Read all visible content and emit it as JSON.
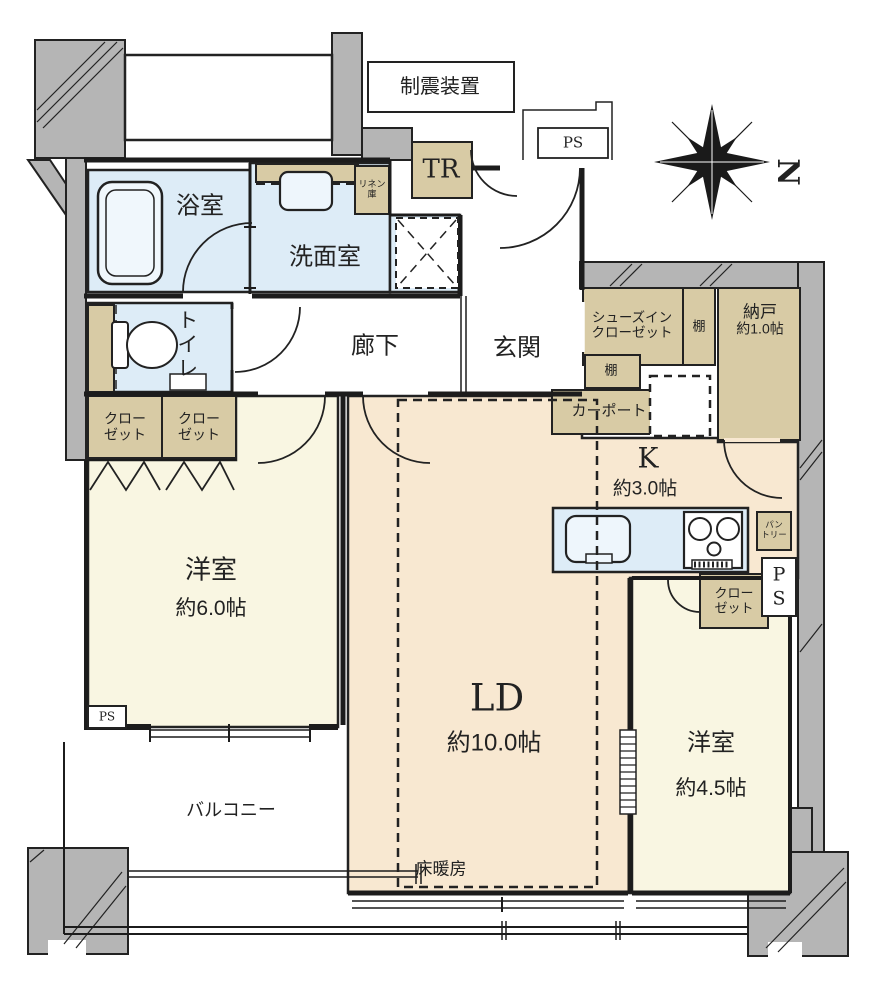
{
  "compass": {
    "north_label": "N"
  },
  "colors": {
    "structure_gray": "#b5b5b5",
    "storage_tan": "#d8cba5",
    "wet_area_blue": "#ddecf7",
    "room_cream": "#f9f6e2",
    "ld_peach": "#f8e8d1",
    "line": "#1c1c1c"
  },
  "rooms": {
    "seismic_device": {
      "label": "制震装置"
    },
    "ps_top": {
      "label": "PS"
    },
    "tr": {
      "label": "TR"
    },
    "linen": {
      "line1": "リネン",
      "line2": "庫"
    },
    "bathroom": {
      "label": "浴室"
    },
    "washroom": {
      "label": "洗面室"
    },
    "toilet": {
      "label": "トイレ"
    },
    "hallway": {
      "label": "廊下"
    },
    "entrance": {
      "label": "玄関"
    },
    "shoes_in_closet": {
      "line1": "シューズイン",
      "line2": "クローゼット"
    },
    "shelf_right": {
      "label": "棚"
    },
    "shelf_lower": {
      "label": "棚"
    },
    "storeroom": {
      "label": "納戸",
      "size": "約1.0帖"
    },
    "carport": {
      "label": "カーポート"
    },
    "kitchen": {
      "label": "K",
      "size": "約3.0帖"
    },
    "pantry": {
      "line1": "パン",
      "line2": "トリー"
    },
    "closet_a": {
      "line1": "クロー",
      "line2": "ゼット"
    },
    "closet_b": {
      "line1": "クロー",
      "line2": "ゼット"
    },
    "closet_c": {
      "line1": "クロー",
      "line2": "ゼット"
    },
    "ps_right": {
      "line1": "P",
      "line2": "S"
    },
    "western_6": {
      "label": "洋室",
      "size": "約6.0帖"
    },
    "living_dining": {
      "label": "LD",
      "size": "約10.0帖"
    },
    "floor_heating": {
      "label": "床暖房"
    },
    "western_45": {
      "label": "洋室",
      "size": "約4.5帖"
    },
    "balcony": {
      "label": "バルコニー"
    },
    "ps_bottom": {
      "label": "PS"
    }
  }
}
